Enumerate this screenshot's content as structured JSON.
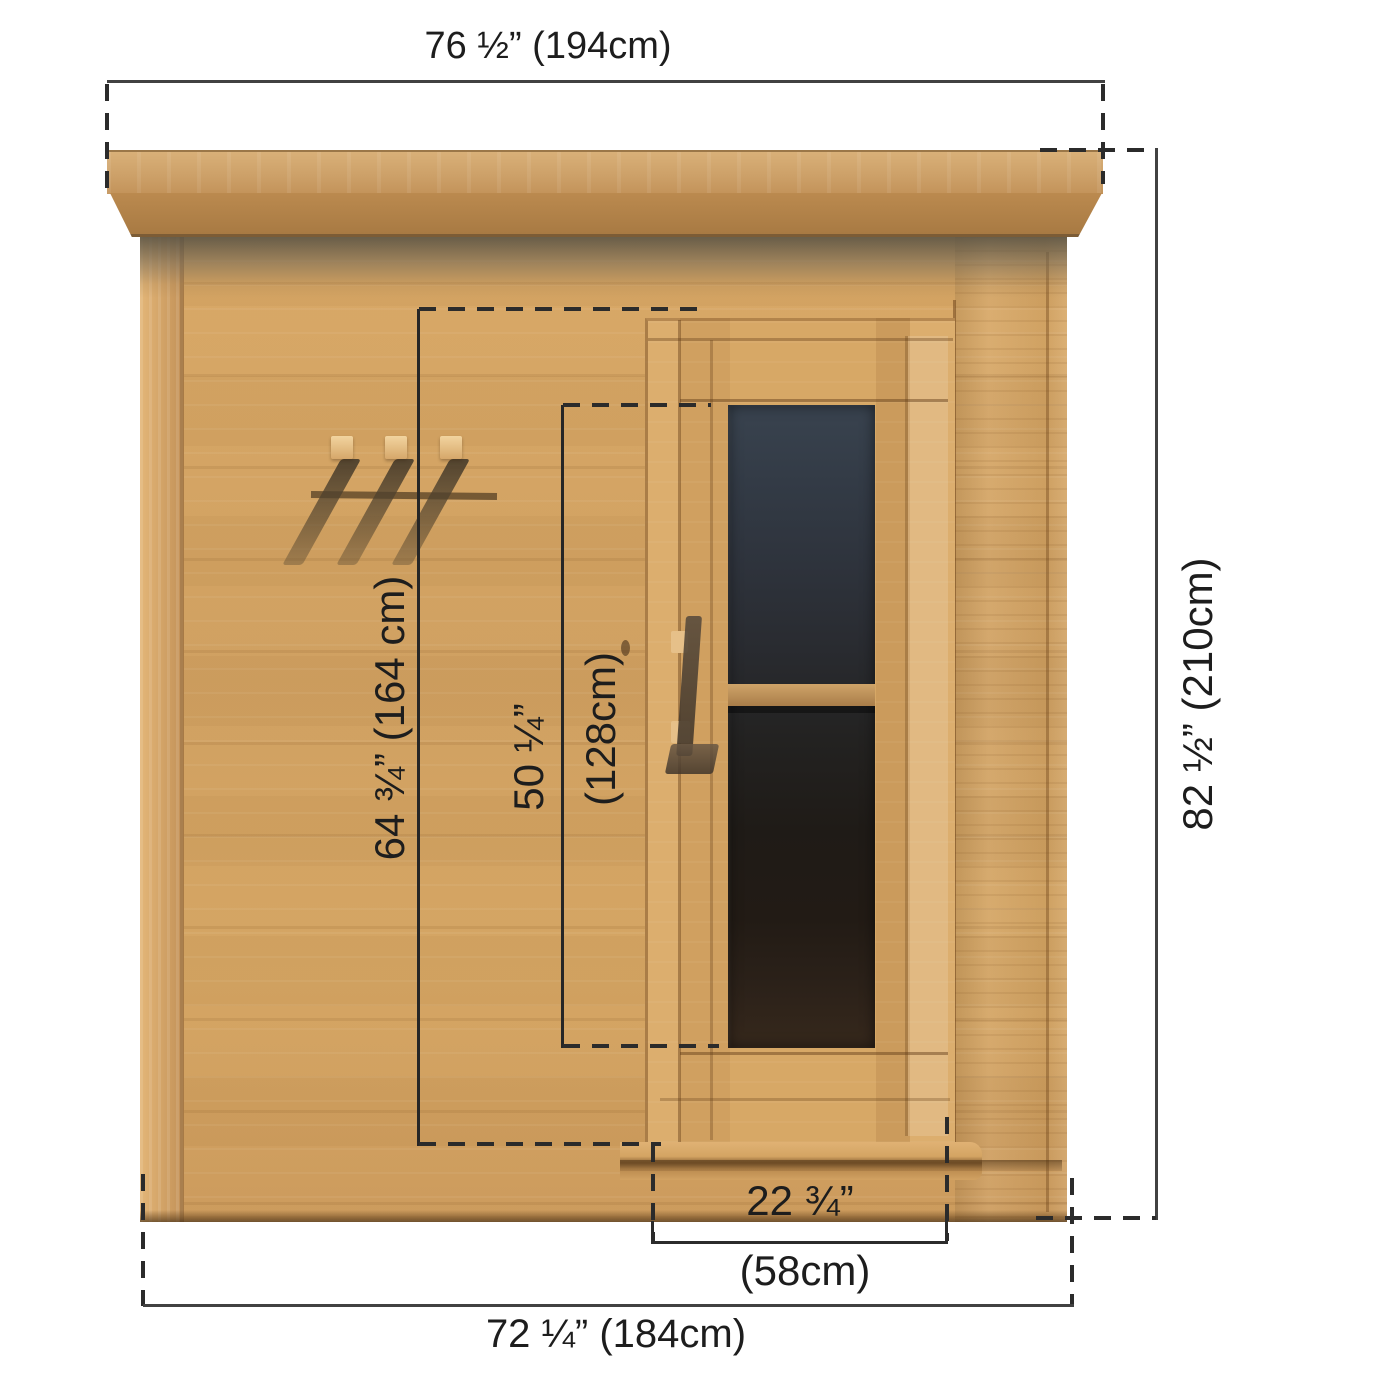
{
  "diagram": {
    "subject": "Outdoor cedar sauna - front elevation dimension drawing",
    "units": "inches (centimeters)"
  },
  "labels": {
    "top_width": "76 ½” (194cm)",
    "overall_height": "82 ½” (210cm)",
    "base_width": "72 ¼” (184cm)",
    "door_width_in": "22 ¾”",
    "door_width_cm": "(58cm)",
    "wall_panel_height": "64 ¾” (164 cm)",
    "door_glass_height_in": "50 ¼”",
    "door_glass_height_cm": "(128cm)"
  },
  "colors": {
    "wood_light": "#d9a967",
    "wood_mid": "#cf9f5f",
    "wood_dark": "#a87a42",
    "roof_shadow": "#6f695c",
    "glass_top": "#39434f",
    "glass_bottom": "#33261b",
    "dimension_line": "#414141",
    "dash_line": "#2b2b2b",
    "text": "#1d1d1d",
    "background": "#ffffff"
  }
}
